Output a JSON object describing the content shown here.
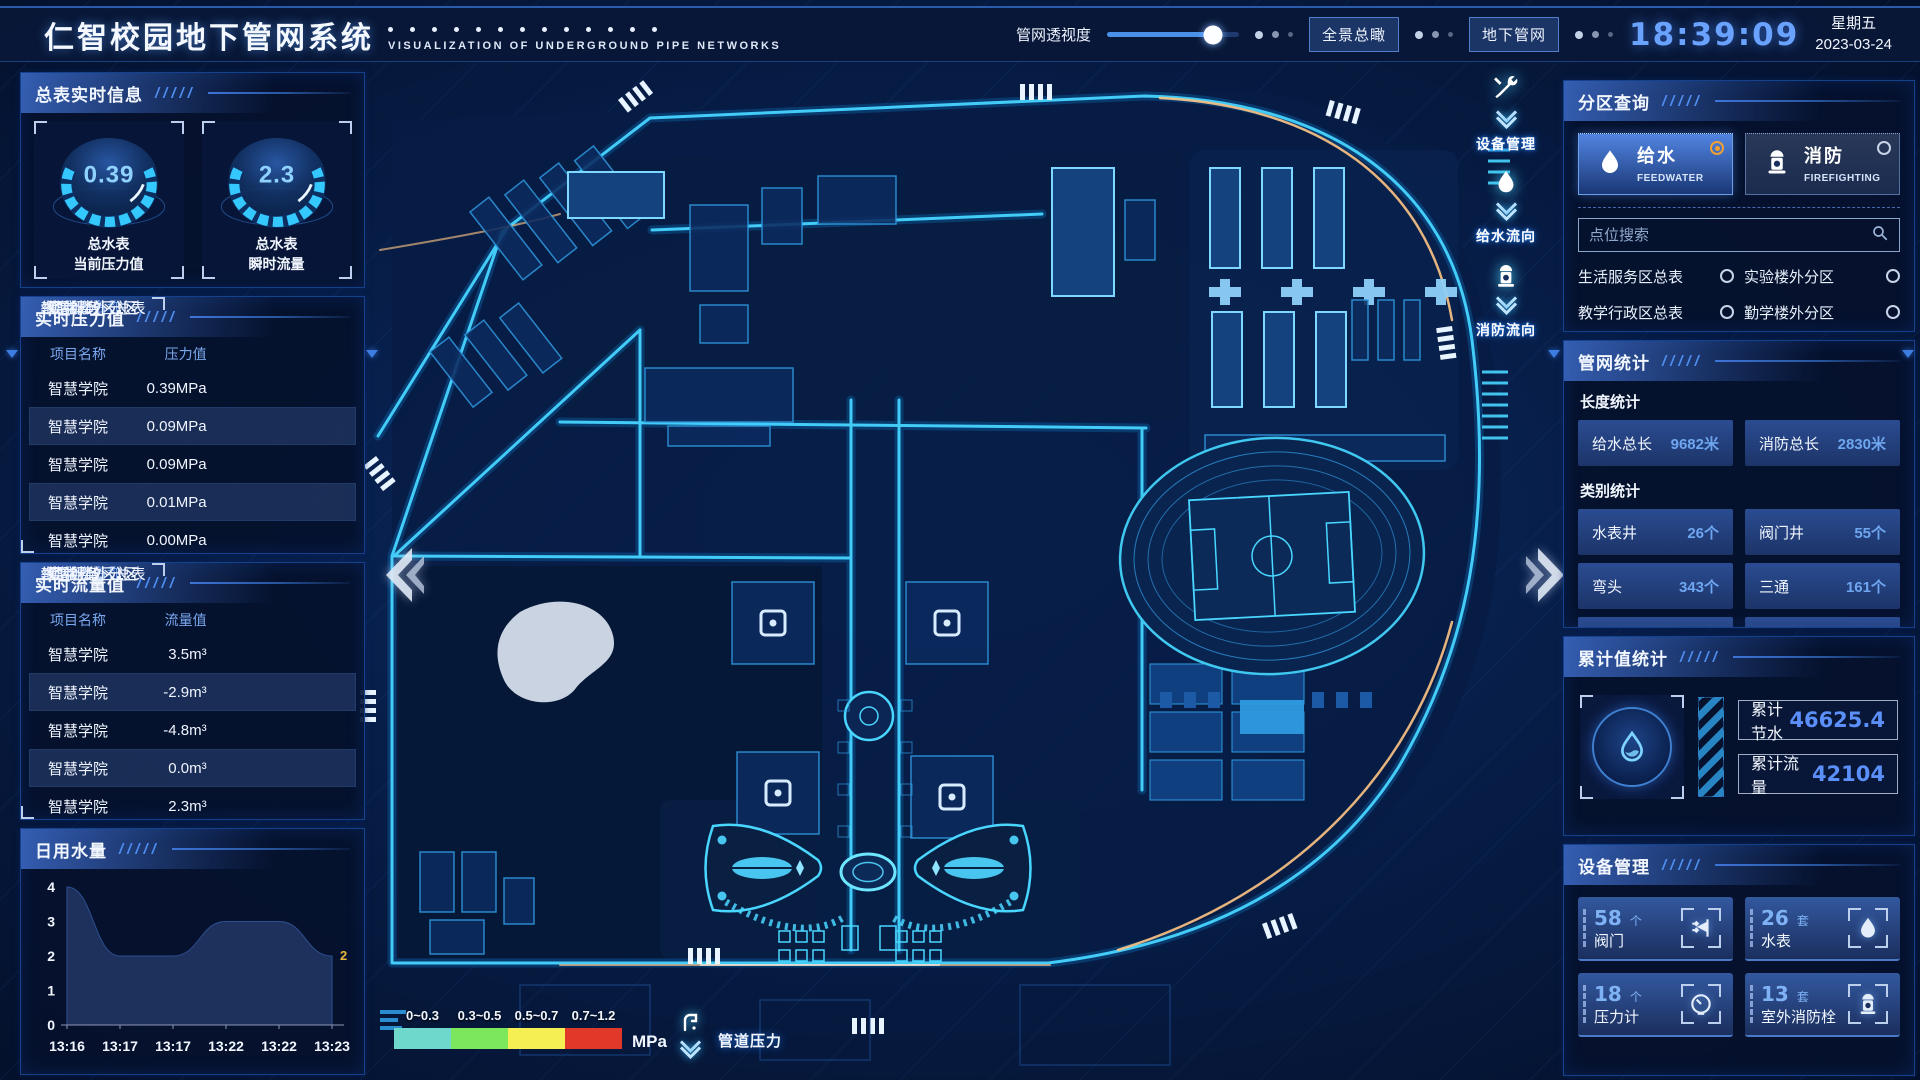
{
  "header": {
    "title": "仁智校园地下管网系统",
    "subtitle": "VISUALIZATION OF UNDERGROUND PIPE NETWORKS",
    "slider_label": "管网透视度",
    "buttons": [
      {
        "label": "全景总瞰"
      },
      {
        "label": "地下管网"
      }
    ],
    "clock": "18:39:09",
    "weekday": "星期五",
    "date": "2023-03-24"
  },
  "left": {
    "meter_panel": {
      "title": "总表实时信息",
      "gauges": [
        {
          "value": "0.39",
          "label1": "总水表",
          "label2": "当前压力值"
        },
        {
          "value": "2.3",
          "label1": "总水表",
          "label2": "瞬时流量"
        }
      ]
    },
    "pressure_panel": {
      "title": "实时压力值",
      "columns": {
        "c1": "项目名称",
        "c2": "设备名称",
        "c3": "压力值"
      },
      "rows": [
        {
          "project": "智慧学院",
          "device": "生活服务区总表",
          "value": "0.39MPa"
        },
        {
          "project": "智慧学院",
          "device": "实验楼外分区",
          "value": "0.09MPa"
        },
        {
          "project": "智慧学院",
          "device": "教学行政区总表",
          "value": "0.09MPa"
        },
        {
          "project": "智慧学院",
          "device": "勤学楼外分区",
          "value": "0.01MPa"
        },
        {
          "project": "智慧学院",
          "device": "砺学楼外分区",
          "value": "0.00MPa"
        }
      ]
    },
    "flow_panel": {
      "title": "实时流量值",
      "columns": {
        "c1": "项目名称",
        "c2": "设备名称",
        "c3": "流量值"
      },
      "rows": [
        {
          "project": "智慧学院",
          "device": "生活服务区总表",
          "value": "3.5m³"
        },
        {
          "project": "智慧学院",
          "device": "实验楼外分区",
          "value": "-2.9m³"
        },
        {
          "project": "智慧学院",
          "device": "教学行政区总表",
          "value": "-4.8m³"
        },
        {
          "project": "智慧学院",
          "device": "勤学楼外分区",
          "value": "0.0m³"
        },
        {
          "project": "智慧学院",
          "device": "砺学楼外分区",
          "value": "2.3m³"
        }
      ]
    },
    "daily_panel": {
      "title": "日用水量",
      "chart_data": {
        "type": "area",
        "x": [
          "13:16",
          "13:17",
          "13:17",
          "13:22",
          "13:22",
          "13:23"
        ],
        "values": [
          4,
          2,
          2,
          3,
          3,
          2
        ],
        "ylim": [
          0,
          4
        ],
        "yticks": [
          0,
          1,
          2,
          3,
          4
        ],
        "end_label": "2",
        "end_label_color": "#e8b73e"
      }
    }
  },
  "map": {
    "overlay_buttons": [
      {
        "label": "设备管理",
        "icon": "tools-icon"
      },
      {
        "label": "给水流向",
        "icon": "water-drop-icon"
      },
      {
        "label": "消防流向",
        "icon": "hydrant-icon"
      }
    ],
    "legend": {
      "ranges": [
        {
          "label": "0~0.3",
          "color": "#6fd8cc"
        },
        {
          "label": "0.3~0.5",
          "color": "#7ce65c"
        },
        {
          "label": "0.5~0.7",
          "color": "#f5ef53"
        },
        {
          "label": "0.7~1.2",
          "color": "#e0392a"
        }
      ],
      "unit": "MPa",
      "label": "管道压力"
    }
  },
  "right": {
    "zone_panel": {
      "title": "分区查询",
      "tabs": [
        {
          "label": "给水",
          "sub": "FEEDWATER",
          "selected": true
        },
        {
          "label": "消防",
          "sub": "FIREFIGHTING",
          "selected": false
        }
      ],
      "search_placeholder": "点位搜索",
      "items": [
        "生活服务区总表",
        "实验楼外分区",
        "教学行政区总表",
        "勤学楼外分区",
        "砺学楼外分区",
        "宿舍区泵房"
      ]
    },
    "stats_panel": {
      "title": "管网统计",
      "length_section": "长度统计",
      "length_stats": [
        {
          "label": "给水总长",
          "value": "9682米"
        },
        {
          "label": "消防总长",
          "value": "2830米"
        }
      ],
      "category_section": "类别统计",
      "category_stats": [
        {
          "label": "水表井",
          "value": "26个"
        },
        {
          "label": "阀门井",
          "value": "55个"
        },
        {
          "label": "弯头",
          "value": "343个"
        },
        {
          "label": "三通",
          "value": "161个"
        }
      ]
    },
    "cumulative_panel": {
      "title": "累计值统计",
      "stats": [
        {
          "label": "累计节水",
          "value": "46625.4"
        },
        {
          "label": "累计流量",
          "value": "42104"
        }
      ]
    },
    "device_panel": {
      "title": "设备管理",
      "cards": [
        {
          "count": "58",
          "unit": "个",
          "label": "阀门",
          "icon": "valve-icon"
        },
        {
          "count": "26",
          "unit": "套",
          "label": "水表",
          "icon": "water-meter-icon"
        },
        {
          "count": "18",
          "unit": "个",
          "label": "压力计",
          "icon": "pressure-gauge-icon"
        },
        {
          "count": "13",
          "unit": "套",
          "label": "室外消防栓",
          "icon": "hydrant-icon"
        }
      ]
    }
  }
}
